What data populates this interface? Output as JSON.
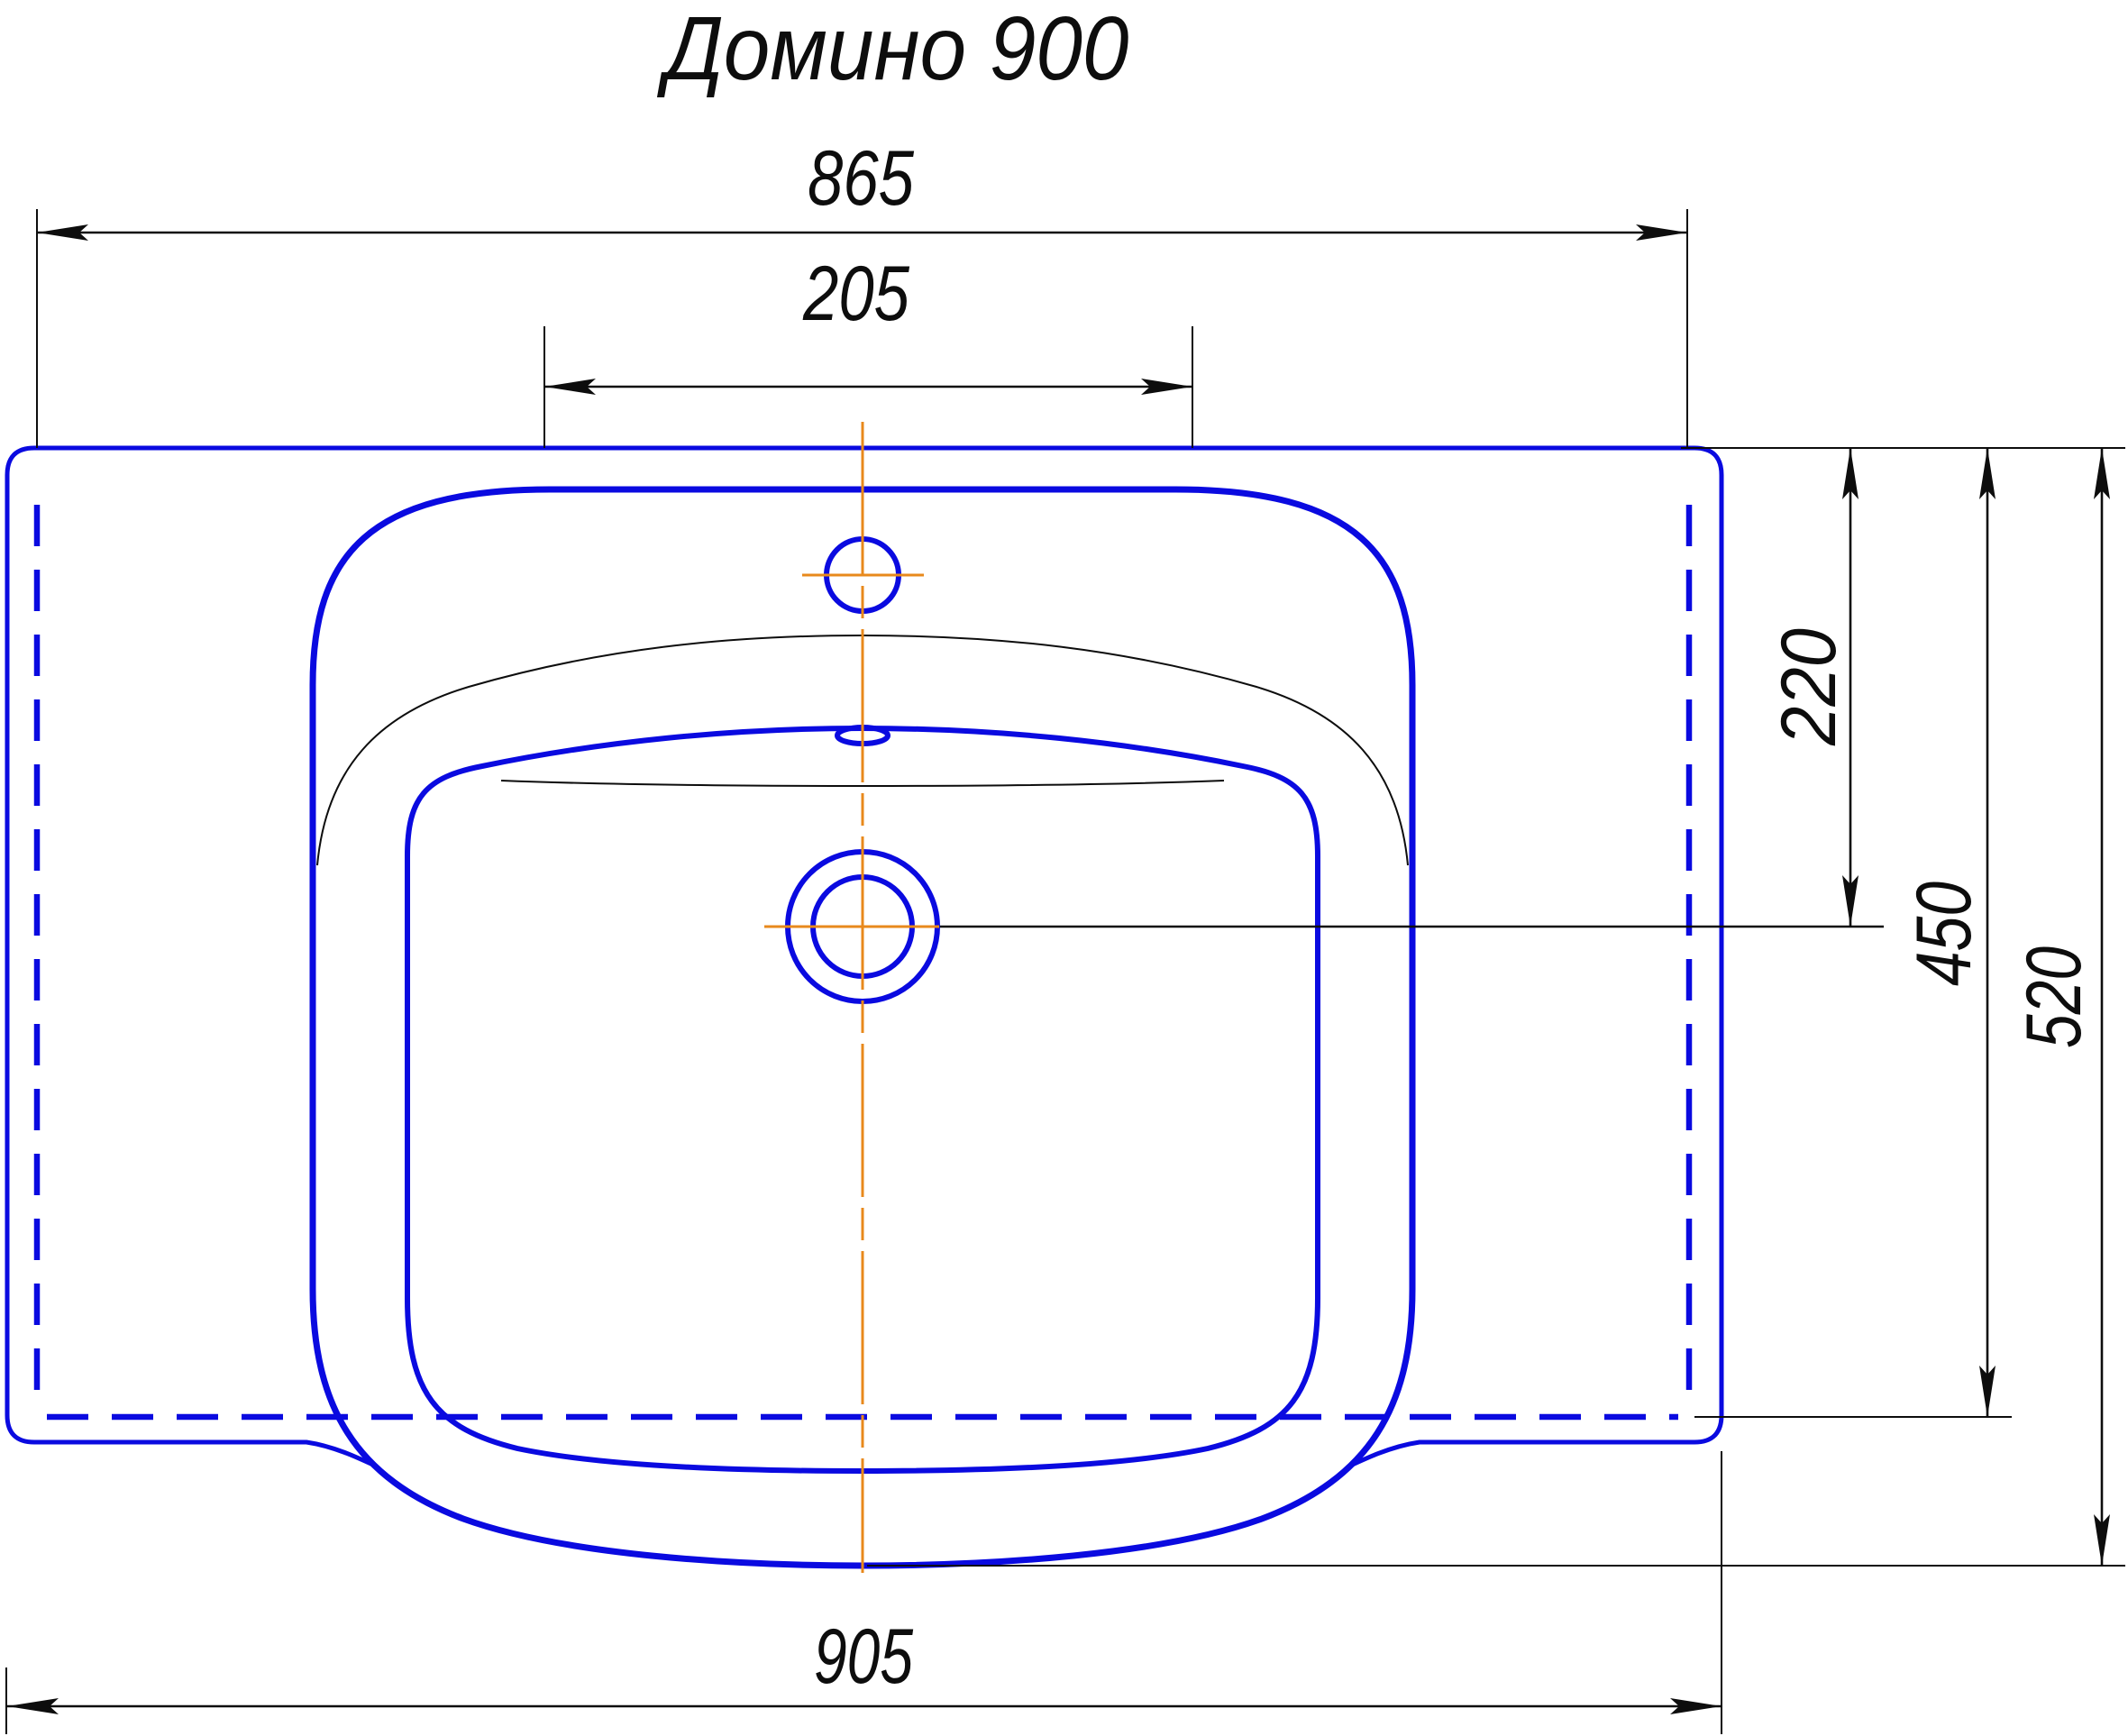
{
  "title": "Домино 900",
  "drawing": {
    "object": "washbasin-top-view",
    "dimensions": {
      "width_865": "865",
      "faucet_zone_205": "205",
      "depth_220": "220",
      "depth_450": "450",
      "depth_520": "520",
      "width_905": "905"
    }
  },
  "colors": {
    "outline_blue": "#0a0ae0",
    "centerline_orange": "#e8891c",
    "line_black": "#0d0d0d",
    "background": "#ffffff"
  }
}
